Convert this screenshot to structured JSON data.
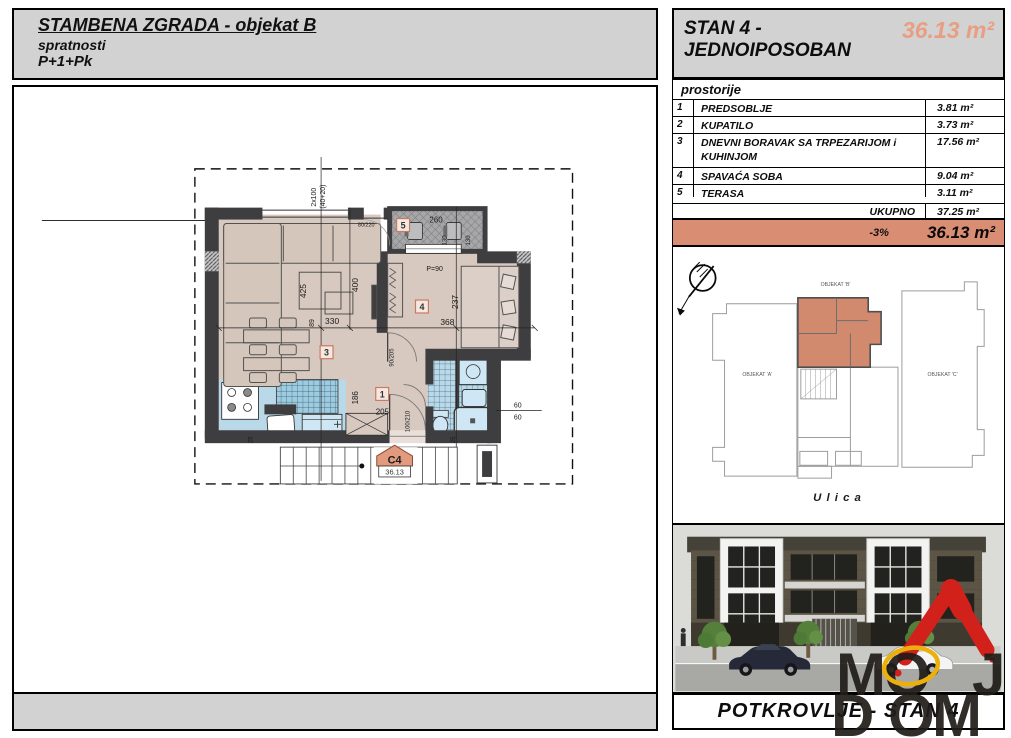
{
  "header": {
    "title": "STAMBENA ZGRADA - objekat B",
    "line2": "spratnosti",
    "line3": "P+1+Pk"
  },
  "apartment": {
    "name_line1": "STAN 4 -",
    "name_line2": "JEDNOIPOSOBAN",
    "area": "36.13 m²"
  },
  "rooms_table": {
    "header": "prostorije",
    "rows": [
      {
        "num": "1",
        "name": "PREDSOBLJE",
        "area": "3.81 m²"
      },
      {
        "num": "2",
        "name": "KUPATILO",
        "area": "3.73 m²"
      },
      {
        "num": "3",
        "name": "DNEVNI BORAVAK SA TRPEZARIJOM i KUHINJOM",
        "area": "17.56 m²"
      },
      {
        "num": "4",
        "name": "SPAVAĆA SOBA",
        "area": "9.04 m²"
      },
      {
        "num": "5",
        "name": "TERASA",
        "area": "3.11 m²"
      }
    ],
    "total_label": "UKUPNO",
    "total_area": "37.25 m²",
    "discount_label": "-3%",
    "final_area": "36.13 m²"
  },
  "floor_plan": {
    "marker_label": "C4",
    "marker_area": "36.13",
    "room_labels": {
      "r1": "1",
      "r3": "3",
      "r4": "4",
      "r5": "5"
    },
    "dimensions": {
      "stairs_top": "2x100",
      "stairs_top2": "(40+20)",
      "living_h": "400",
      "living_h2": "425",
      "living_w": "330",
      "living_s": "89",
      "bedroom_w": "368",
      "bedroom_h": "237",
      "terrace_w": "260",
      "terrace_chair_a": "130",
      "terrace_chair_b": "130",
      "terrace_window": "P=90",
      "door_top": "80/220",
      "hall_h": "186",
      "hall_w": "205",
      "entry_door": "100/210",
      "bedroom_door": "90/205",
      "vent_a": "60",
      "vent_b": "60",
      "wall_a": "25",
      "wall_b": "25"
    }
  },
  "site_plan": {
    "building_a": "OBJEKAT 'A'",
    "building_b": "OBJEKAT 'B'",
    "building_c": "OBJEKAT 'C'",
    "street": "U l i c a"
  },
  "footer": {
    "label": "POTKROVLJE - STAN 4"
  },
  "logo": {
    "line1_m": "M",
    "line1_o": "O",
    "line1_j": "J",
    "line2_d": "D",
    "line2_o": "O",
    "line2_m": "M"
  },
  "colors": {
    "header_gray": "#d2d2d2",
    "accent_salmon_row": "#d98d72",
    "area_text_salmon": "#e89e82",
    "floor_beige": "#d8c9c0",
    "tile_blue": "#b9d9e9",
    "wall_dark": "#3e3e40",
    "terrace_gray": "#a7a7a9",
    "site_apartment": "#d28a6e",
    "logo_red": "#d2201a",
    "logo_yellow": "#ecb00c"
  }
}
